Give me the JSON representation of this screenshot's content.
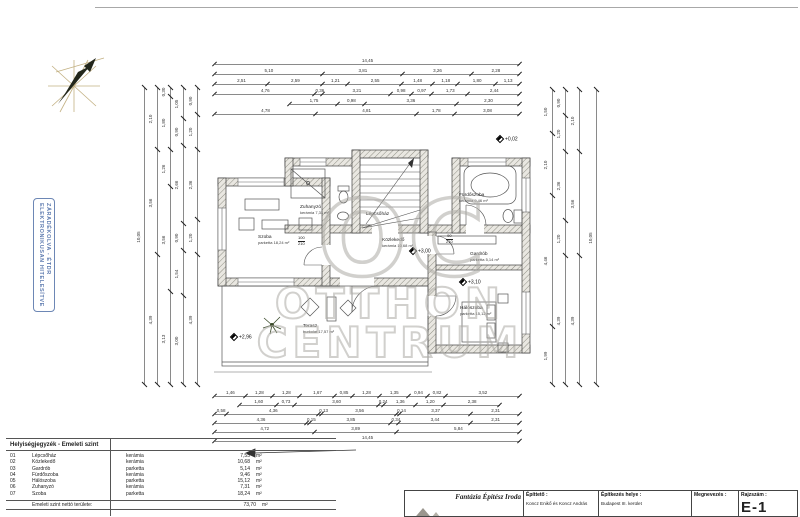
{
  "stamp": {
    "line1": "ELEKTRONIKUSAN HITELESÍTVE",
    "line2": "ZÁRADÉKOLVA - ÉTDR",
    "color": "#5f7cb0"
  },
  "watermark": {
    "logo": "OC",
    "line1": "OTTHON",
    "line2": "CENTRUM",
    "color": "#acaaa4"
  },
  "plan": {
    "rooms": [
      {
        "name": "Szoba",
        "sub": "parketta  18,24 m²"
      },
      {
        "name": "Zuhanyzó",
        "sub": "kerámia  7,31 m²"
      },
      {
        "name": "Lépcsőház",
        "sub": "kerámia  7,55 m²"
      },
      {
        "name": "Fürdőszoba",
        "sub": "kerámia  9,46 m²"
      },
      {
        "name": "Gardrób",
        "sub": "parketta  5,14 m²"
      },
      {
        "name": "Közlekedő",
        "sub": "kerámia  10,68 m²"
      },
      {
        "name": "Hálószoba",
        "sub": "parketta  15,12 m²"
      },
      {
        "name": "Terasz",
        "sub": "burkolat  17,57 m²"
      }
    ],
    "levels": {
      "entry": "+0,02",
      "hall": "+3,00",
      "bedroom": "+3,10",
      "terrace": "+2,96"
    },
    "doors": [
      {
        "w": "100",
        "h": "210"
      },
      {
        "w": "90",
        "h": "210"
      }
    ]
  },
  "dims": {
    "t1": [
      "14,45"
    ],
    "t2": [
      "5,10",
      "3,81",
      "3,26",
      "2,28"
    ],
    "t3": [
      "2,51",
      "2,59",
      "1,21",
      "2,55",
      "1,48",
      "1,18",
      "1,80",
      "1,13"
    ],
    "t4": [
      "4,76",
      "0,36",
      "3,21",
      "0,98",
      "0,97",
      "1,73",
      "2,44"
    ],
    "t5": [
      "1,75",
      "0,98",
      "3,36",
      "2,30"
    ],
    "t6": [
      "4,78",
      "4,81",
      "1,78",
      "3,08"
    ],
    "b1": [
      "1,46",
      "1,28",
      "1,28",
      "1,67",
      "0,85",
      "1,28",
      "1,35",
      "0,94",
      "0,82",
      "3,52"
    ],
    "b2": [
      "1,60",
      "0,73",
      "3,60",
      "0,24",
      "1,36",
      "1,20",
      "2,38"
    ],
    "b3": [
      "0,58",
      "4,36",
      "0,13",
      "3,56",
      "0,14",
      "3,37",
      "2,31"
    ],
    "b4": [
      "4,36",
      "0,15",
      "3,85",
      "0,34",
      "3,44",
      "2,31"
    ],
    "b5": [
      "4,72",
      "3,89",
      "5,84"
    ],
    "b6": [
      "14,45"
    ],
    "l1": [
      "10,05"
    ],
    "l2": [
      "2,10",
      "3,56",
      "4,39"
    ],
    "l3": [
      "0,30",
      "1,80",
      "1,26",
      "3,56",
      "3,13"
    ],
    "l4": [
      "1,05",
      "0,90",
      "2,66",
      "0,90",
      "1,54",
      "3,00"
    ],
    "l5": [
      "0,90",
      "1,20",
      "2,36",
      "1,20",
      "4,39"
    ],
    "r1": [
      "1,50",
      "2,10",
      "4,46",
      "1,99"
    ],
    "r2": [
      "0,90",
      "1,20",
      "2,36",
      "1,20",
      "4,39"
    ],
    "r3": [
      "2,10",
      "3,56",
      "4,39"
    ],
    "r4": [
      "10,05"
    ]
  },
  "legend": {
    "title": "Helyiségjegyzék - Emeleti szint",
    "rows": [
      {
        "num": "01",
        "name": "Lépcsőház",
        "material": "kerámia",
        "area": "7,55",
        "unit": "m²"
      },
      {
        "num": "02",
        "name": "Közlekedő",
        "material": "kerámia",
        "area": "10,68",
        "unit": "m²"
      },
      {
        "num": "03",
        "name": "Gardrób",
        "material": "parketta",
        "area": "5,14",
        "unit": "m²"
      },
      {
        "num": "04",
        "name": "Fürdőszoba",
        "material": "kerámia",
        "area": "9,46",
        "unit": "m²"
      },
      {
        "num": "05",
        "name": "Hálószoba",
        "material": "parketta",
        "area": "15,12",
        "unit": "m²"
      },
      {
        "num": "06",
        "name": "Zuhanyzó",
        "material": "kerámia",
        "area": "7,31",
        "unit": "m²"
      },
      {
        "num": "07",
        "name": "Szoba",
        "material": "parketta",
        "area": "18,24",
        "unit": "m²"
      }
    ],
    "total": {
      "label": "Emeleti szint nettó területe:",
      "value": "73,70",
      "unit": "m²"
    }
  },
  "titleblock": {
    "company": "Fantázia Építész Iroda",
    "epitteto_label": "Építtető :",
    "epitteto_value": "Koncz Enikő és Koncz  András",
    "helye_label": "Építkezés helye :",
    "helye_value": "Budapest  III. kerület",
    "megnevezes_label": "Megnevezés :",
    "rajzszam_label": "Rajzszám :",
    "rajzszam_value": "E-1"
  }
}
